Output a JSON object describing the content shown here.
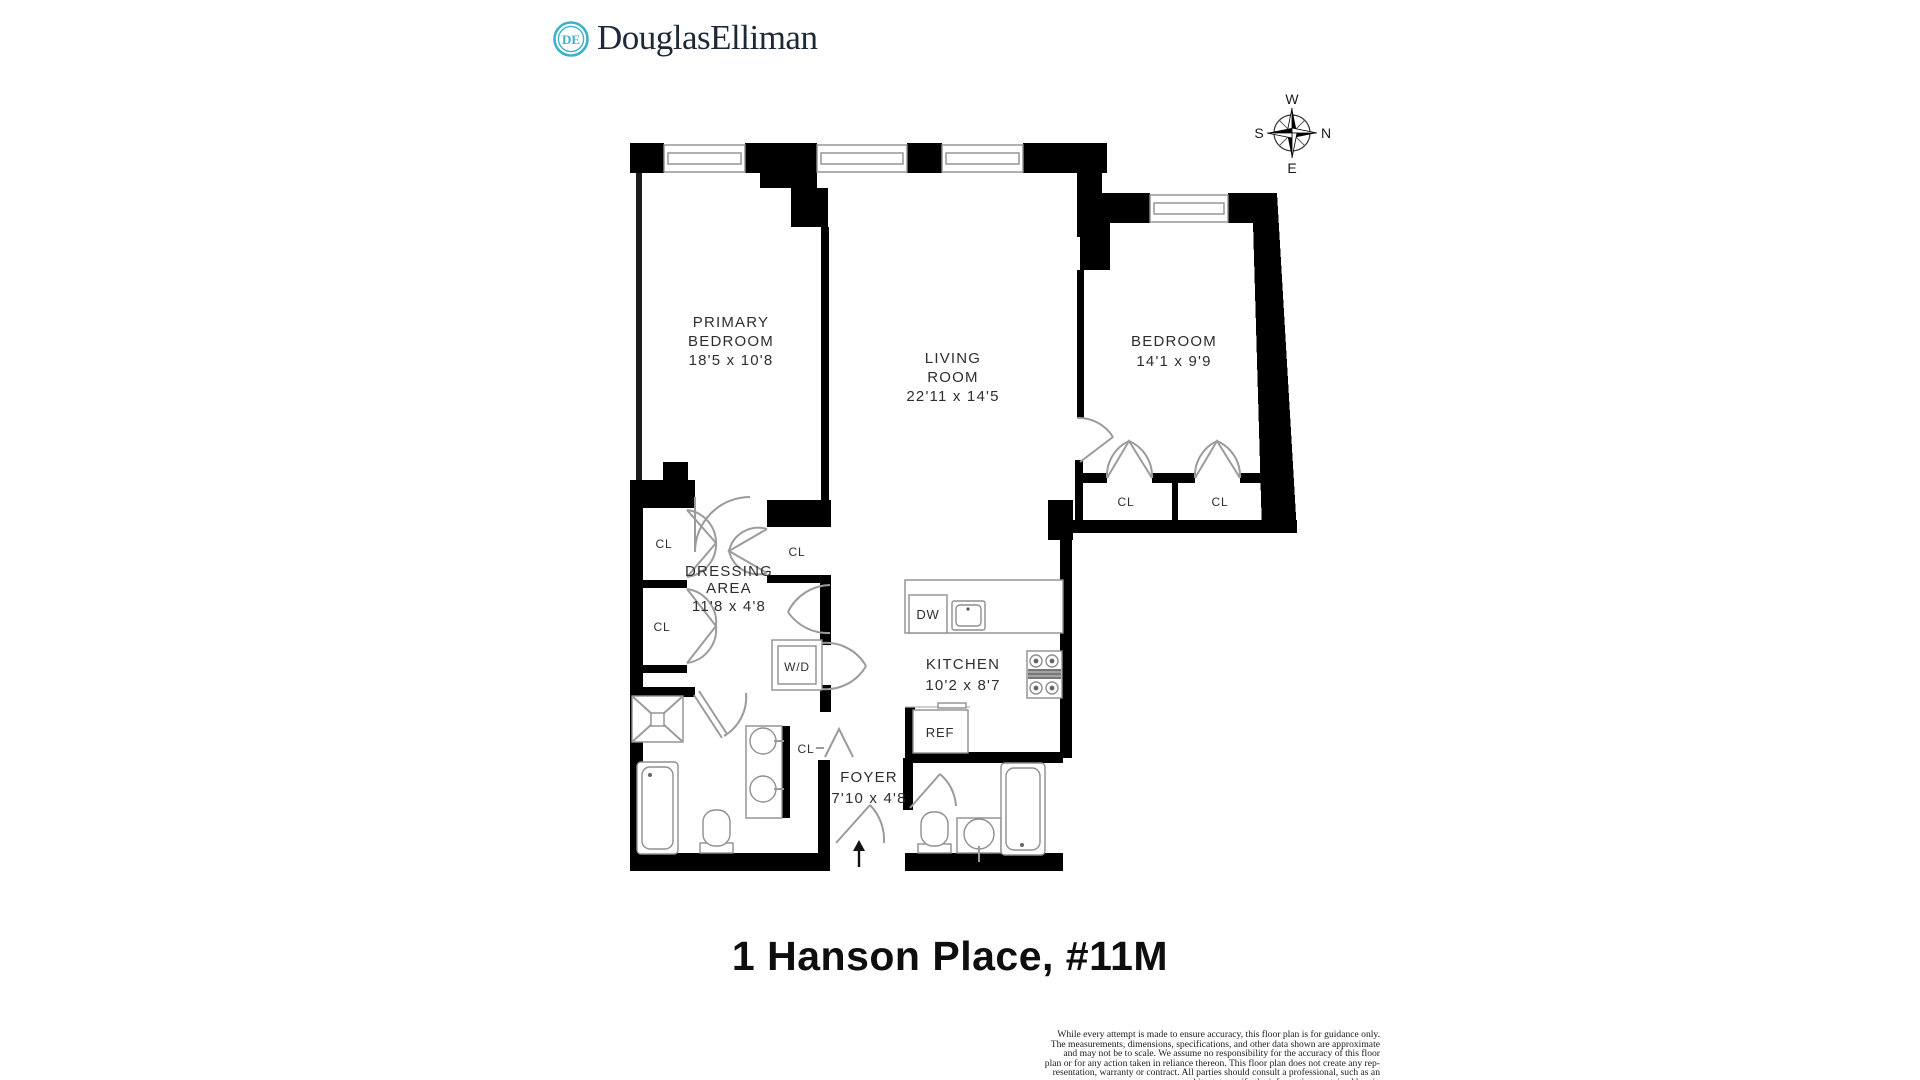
{
  "brand": {
    "logo_text": "DouglasElliman",
    "monogram": "DE",
    "teal": "#3eb1c8",
    "navy": "#1d2936"
  },
  "title": "1 Hanson Place, #11M",
  "compass": {
    "top": "W",
    "right": "N",
    "bottom": "E",
    "left": "S"
  },
  "rooms": {
    "primary_bedroom": {
      "line1": "PRIMARY",
      "line2": "BEDROOM",
      "dims": "18'5 x 10'8"
    },
    "living_room": {
      "line1": "LIVING",
      "line2": "ROOM",
      "dims": "22'11 x 14'5"
    },
    "bedroom": {
      "line1": "BEDROOM",
      "dims": "14'1 x 9'9"
    },
    "dressing_area": {
      "line1": "DRESSING",
      "line2": "AREA",
      "dims": "11'8 x 4'8"
    },
    "kitchen": {
      "line1": "KITCHEN",
      "dims": "10'2 x 8'7"
    },
    "foyer": {
      "line1": "FOYER",
      "dims": "7'10 x 4'8"
    }
  },
  "fixtures": {
    "closet": "CL",
    "washer_dryer": "W/D",
    "dishwasher": "DW",
    "refrigerator": "REF"
  },
  "disclaimer": {
    "lines": [
      "While every attempt is made to ensure accuracy, this floor plan is for guidance only.",
      "The measurements, dimensions, specifications, and other data shown are approximate",
      "and may not be to scale.  We assume no responsibility for the accuracy of this floor",
      "plan or for any action taken in reliance thereon. This floor plan does not create any rep-",
      "resentation, warranty or contract. All parties should consult a professional, such as an",
      "architect, to verify the information contained herein"
    ]
  },
  "colors": {
    "wall": "#000000",
    "line": "#9b9b9b",
    "text": "#2e2e2e"
  }
}
